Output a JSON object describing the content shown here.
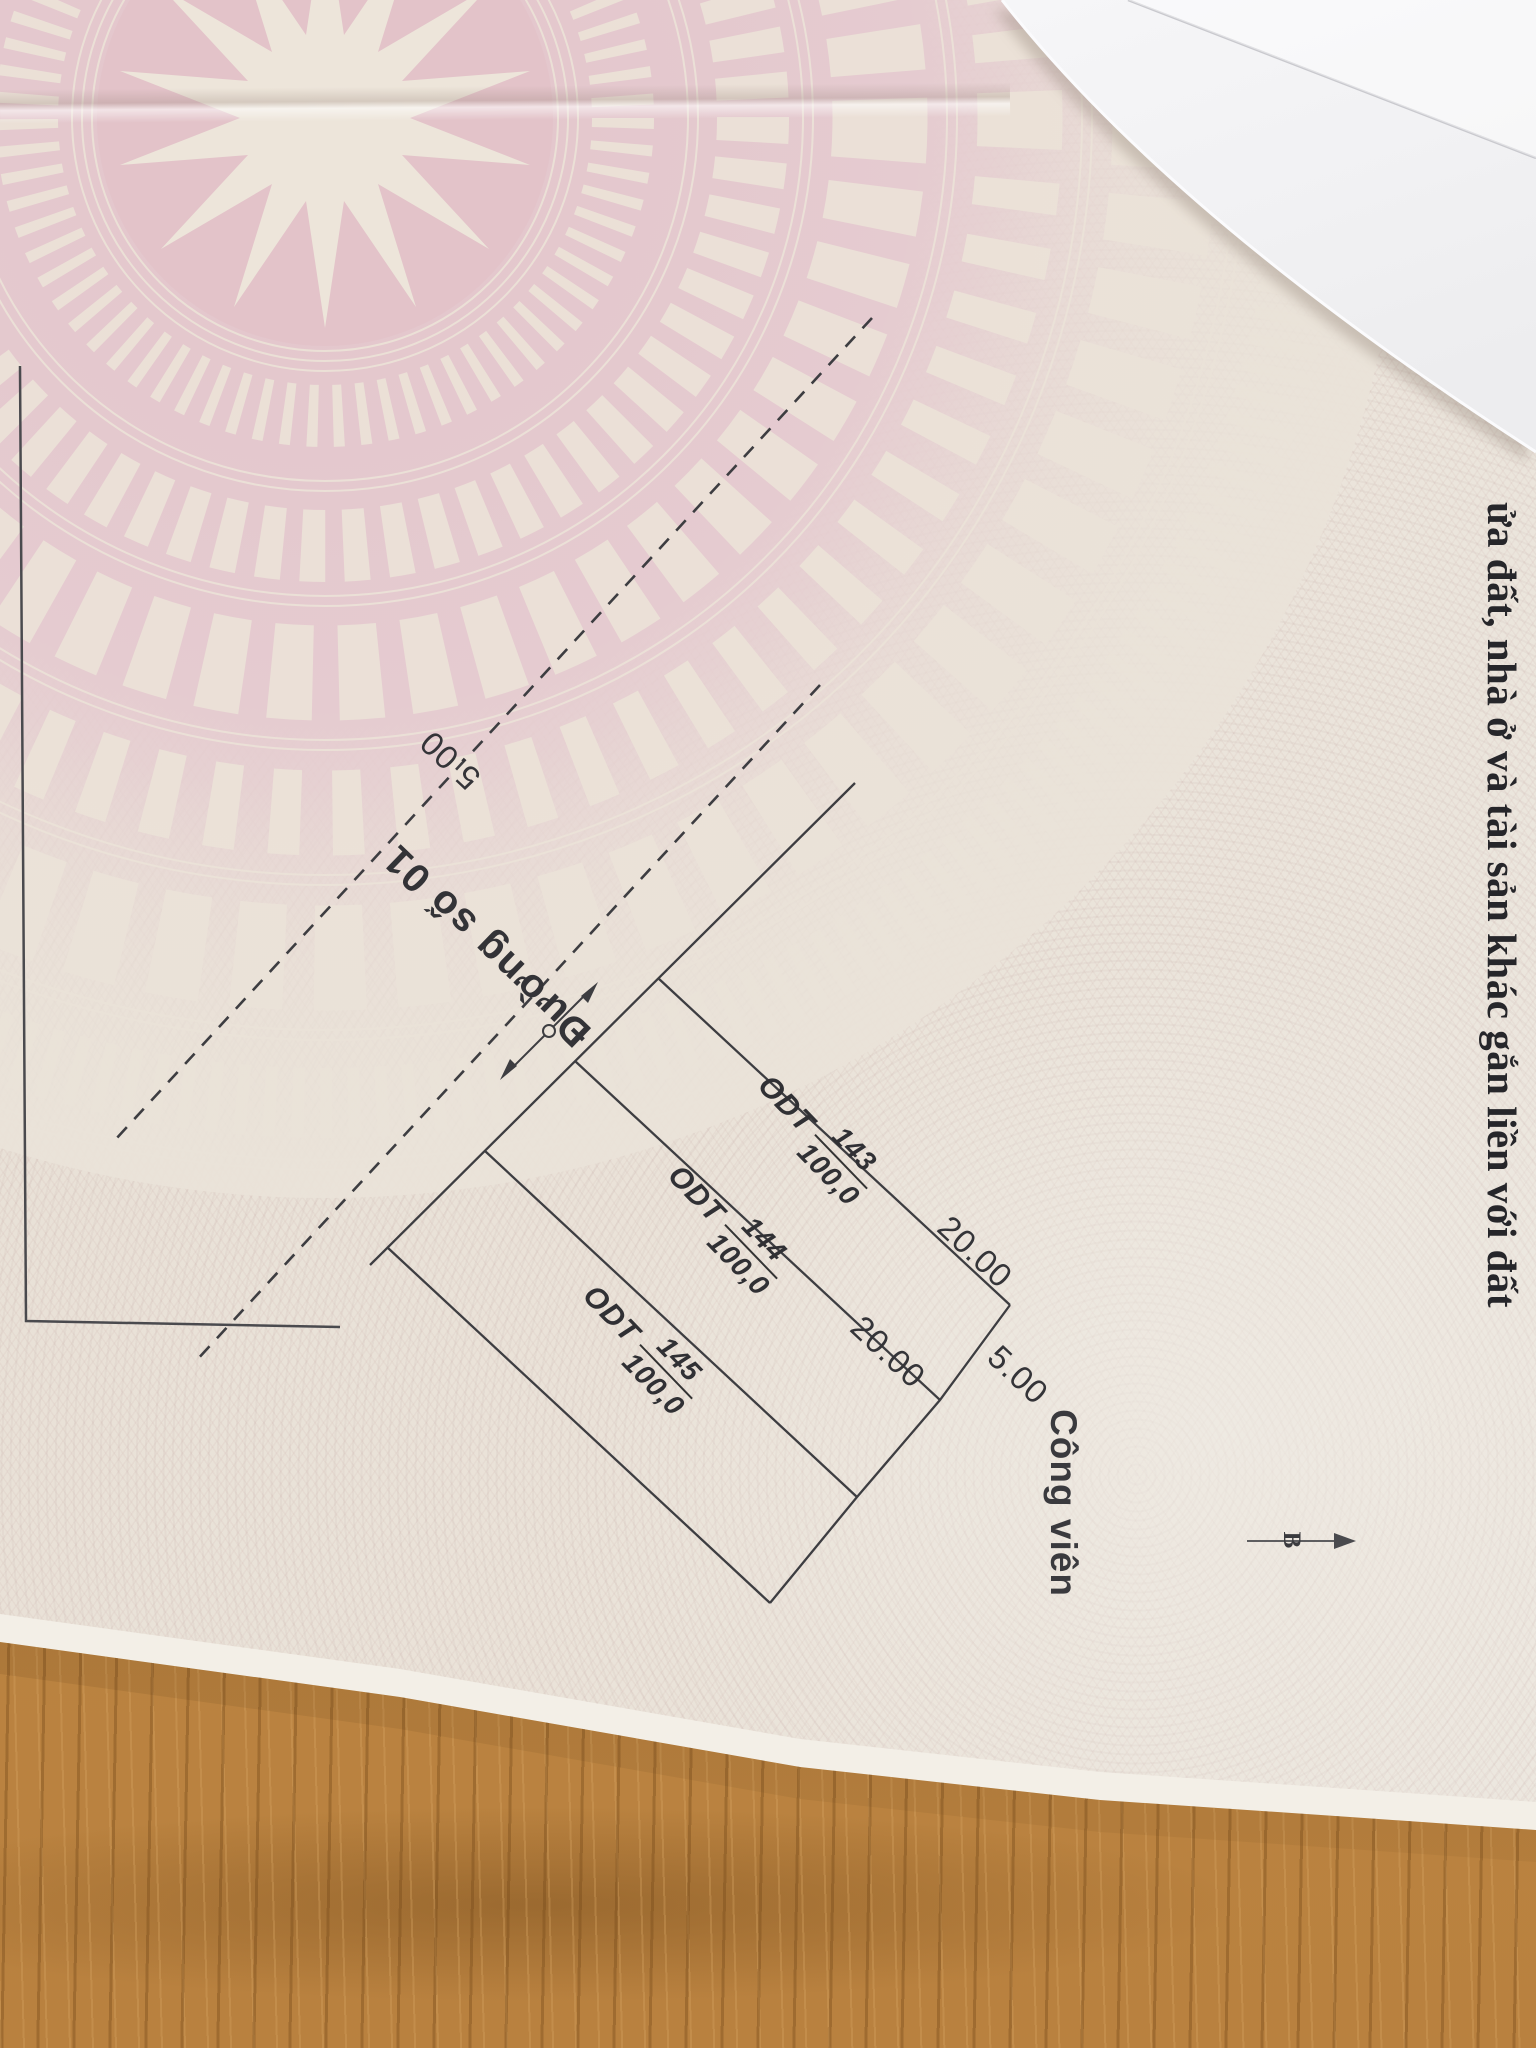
{
  "certificate": {
    "edge_text": "ửa đất, nhà ở và tài sản khác gắn liền với đất",
    "sketch": {
      "road_label": "Đường số 01",
      "park_label": "Công viên",
      "north_label": "B",
      "parcels": [
        {
          "code": "ODT",
          "number": "143",
          "area": "100,0"
        },
        {
          "code": "ODT",
          "number": "144",
          "area": "100,0"
        },
        {
          "code": "ODT",
          "number": "145",
          "area": "100,0"
        }
      ],
      "dims": {
        "top_width": "5.00",
        "len1": "20.00",
        "len2": "20.00",
        "bottom_width": "5.00"
      },
      "dimension_labels": [
        {
          "text": "5.00",
          "position": "road-side"
        },
        {
          "text": "20.00",
          "position": "parcel-143-length"
        },
        {
          "text": "20.00",
          "position": "parcel-144-length"
        },
        {
          "text": "5.00",
          "position": "rear-side"
        }
      ]
    }
  },
  "colors": {
    "drum_pink": "#e3c5cb",
    "ornament_cream": "#ece3d8",
    "paper_cream": "#eae3d9",
    "ink": "#2e2e32",
    "wood": "#b9813f",
    "white_paper": "#f3f3f5"
  }
}
